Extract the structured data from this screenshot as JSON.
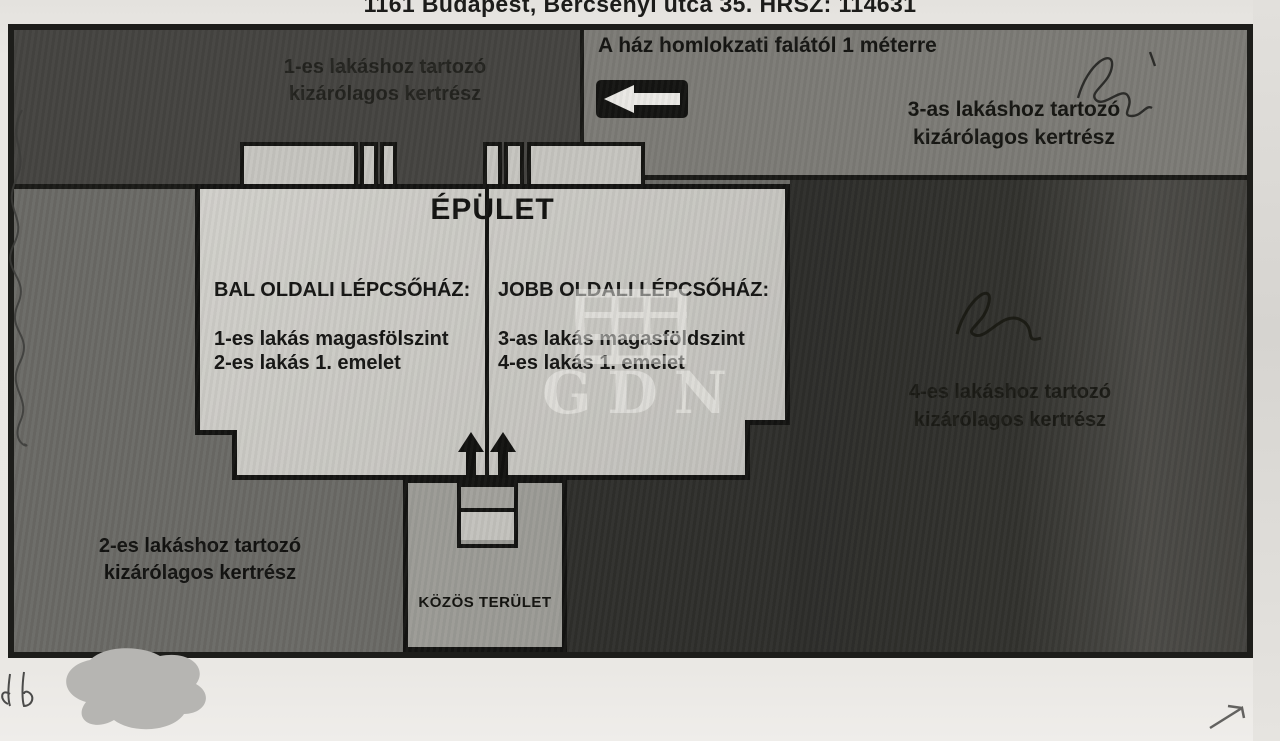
{
  "page": {
    "title": "1161 Budapest, Bercsényi utca 35. HRSZ: 114631"
  },
  "plan": {
    "building": {
      "label": "ÉPÜLET",
      "left_stairwell": {
        "title": "BAL OLDALI LÉPCSŐHÁZ:",
        "line1": "1-es lakás magasfölszint",
        "line2": "2-es lakás 1. emelet"
      },
      "right_stairwell": {
        "title": "JOBB OLDALI LÉPCSŐHÁZ:",
        "line1": "3-as lakás magasföldszint",
        "line2": "4-es lakás 1. emelet"
      }
    },
    "annotation": {
      "text": "A ház homlokzati falától 1 méterre",
      "arrow_icon": "left-arrow"
    },
    "gardens": {
      "apartment1": {
        "label": "1-es lakáshoz tartozó\nkizárólagos kertrész"
      },
      "apartment2": {
        "label": "2-es lakáshoz tartozó\nkizárólagos kertrész"
      },
      "apartment3": {
        "label": "3-as lakáshoz tartozó\nkizárólagos kertrész"
      },
      "apartment4": {
        "label": "4-es lakáshoz tartozó\nkizárólagos kertrész"
      }
    },
    "common_area": {
      "label": "KÖZÖS TERÜLET"
    },
    "watermark": {
      "text": "GDN"
    }
  },
  "colors": {
    "paper": "#e9e7e3",
    "garden1_dark": "#454441",
    "garden2_medium": "#6b6a66",
    "garden3_gray": "#7c7b76",
    "garden4_dark": "#2f2f2c",
    "building_light": "#c8c7c2",
    "common_gray": "#9c9b96",
    "ink": "#141412"
  }
}
